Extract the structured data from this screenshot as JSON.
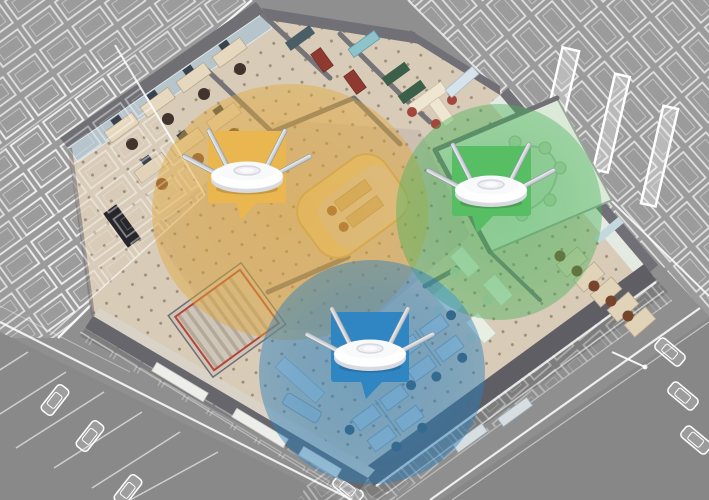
{
  "scene": {
    "width": 709,
    "height": 500,
    "background": "#8F8F8F",
    "subject": "isometric cutaway office floor with three ceiling wifi access points and color coverage circles, surrounded by gray wireframe city buildings",
    "building": {
      "floor_color": "#D8CBB8",
      "lobby_carpet_color": "#CBBCB0",
      "wall_color": "#707076",
      "door_color": "#8F3A31",
      "wireframe_color": "#FFFFFF"
    }
  },
  "zones": [
    {
      "id": "yellow",
      "label": "coverage-zone-yellow",
      "accent": "#E9B64F",
      "overlay": "#E2A838",
      "circle": {
        "cx": 290,
        "cy": 212,
        "rx": 138,
        "ry": 128
      },
      "callout": {
        "x": 208,
        "y": 131,
        "width": 78,
        "height": 72,
        "tail_points": "236,201 258,201 241,220",
        "ap_transform": "translate(247,174)"
      }
    },
    {
      "id": "green",
      "label": "coverage-zone-green",
      "accent": "#57BE64",
      "overlay": "#46B258",
      "circle": {
        "cx": 499,
        "cy": 212,
        "rx": 103,
        "ry": 108
      },
      "callout": {
        "x": 452,
        "y": 146,
        "width": 79,
        "height": 70,
        "tail_points": "472,215 494,215 477,233",
        "ap_transform": "translate(491,188)"
      }
    },
    {
      "id": "blue",
      "label": "coverage-zone-blue",
      "accent": "#2F86C2",
      "overlay": "#2A7FBC",
      "circle": {
        "cx": 372,
        "cy": 372,
        "rx": 113,
        "ry": 112
      },
      "callout": {
        "x": 331,
        "y": 312,
        "width": 78,
        "height": 70,
        "tail_points": "361,381 383,381 366,399",
        "ap_transform": "translate(370,352)"
      }
    }
  ],
  "access_point": {
    "type": "ceiling-mount wireless access point",
    "antenna_count": 4,
    "body_color": "#FFFFFF",
    "antenna_color": "#CBCFD4"
  }
}
